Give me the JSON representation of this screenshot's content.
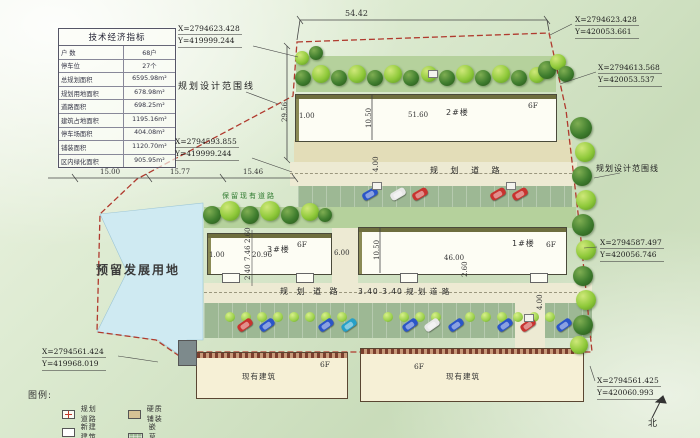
{
  "table": {
    "title": "技术经济指标",
    "rows": [
      {
        "label": "户  数",
        "value": "68户"
      },
      {
        "label": "停车位",
        "value": "27个"
      },
      {
        "label": "总规划面积",
        "value": "6595.98m²"
      },
      {
        "label": "规划用地面积",
        "value": "678.98m²"
      },
      {
        "label": "道路面积",
        "value": "698.25m²"
      },
      {
        "label": "建筑占地面积",
        "value": "1195.16m²"
      },
      {
        "label": "停车场面积",
        "value": "404.08m²"
      },
      {
        "label": "铺装面积",
        "value": "1120.70m²"
      },
      {
        "label": "区内绿化面积",
        "value": "905.95m²"
      }
    ]
  },
  "coordinates": {
    "top_left": {
      "x": "X=2794623.428",
      "y": "Y=419999.244"
    },
    "top_right": {
      "x": "X=2794623.428",
      "y": "Y=420053.661"
    },
    "right_upper": {
      "x": "X=2794613.568",
      "y": "Y=420053.537"
    },
    "mid_left": {
      "x": "X=2794593.855",
      "y": "Y=419999.244"
    },
    "right_mid": {
      "x": "X=2794587.497",
      "y": "Y=420056.746"
    },
    "bottom_right": {
      "x": "X=2794561.425",
      "y": "Y=420060.993"
    },
    "bottom_left": {
      "x": "X=2794561.424",
      "y": "Y=419968.019"
    }
  },
  "dimensions": {
    "top_width": "54.42",
    "left_height": "29.56",
    "seg_a": "15.00",
    "seg_b": "15.77",
    "seg_c": "15.46",
    "b2_gap": "1.00",
    "b2_depth": "10.50",
    "b2_len": "51.60",
    "b1_depth": "10.50",
    "b1_len": "46.00",
    "gap_6": "6.00",
    "b3_gap": "1.00",
    "b3_len": "20.96",
    "v1": "2.60",
    "v2": "7.46",
    "v3": "2.40",
    "road_w_upper": "4.00",
    "road_w_lower": "4.00",
    "b1_2_60": "2.60"
  },
  "labels": {
    "boundary_line": "规划设计范围线",
    "road_upper": "规 划 道 路",
    "road_lower_left": "规 划 道 路",
    "road_lower_right": "3.40 3.40 规 划 道 路",
    "keep_road": "保留现有道路",
    "reserved_land": "预留发展用地",
    "building1": "1#楼",
    "building2": "2#楼",
    "building3": "3#楼",
    "floors": "6F",
    "existing": "现有建筑",
    "north": "北"
  },
  "legend": {
    "title": "图例:",
    "items": [
      {
        "label": "规划道路",
        "symbol": "road-symbol"
      },
      {
        "label": "新建建筑",
        "symbol": "new-building-symbol"
      },
      {
        "label": "硬质铺装",
        "symbol": "hard-paving-symbol"
      },
      {
        "label": "嵌草砖",
        "symbol": "grass-brick-symbol"
      }
    ]
  },
  "colors": {
    "boundary": "#b03a2e",
    "road": "#edead3",
    "parking": "#9db894",
    "plaza": "#e3ddb8",
    "reserved_water": "#cfeaf2",
    "tree_dark": "#3f7d2e",
    "tree_light": "#8fc93a",
    "building_fill": "#fdfdf4",
    "existing_fill": "#f6f0d6"
  }
}
